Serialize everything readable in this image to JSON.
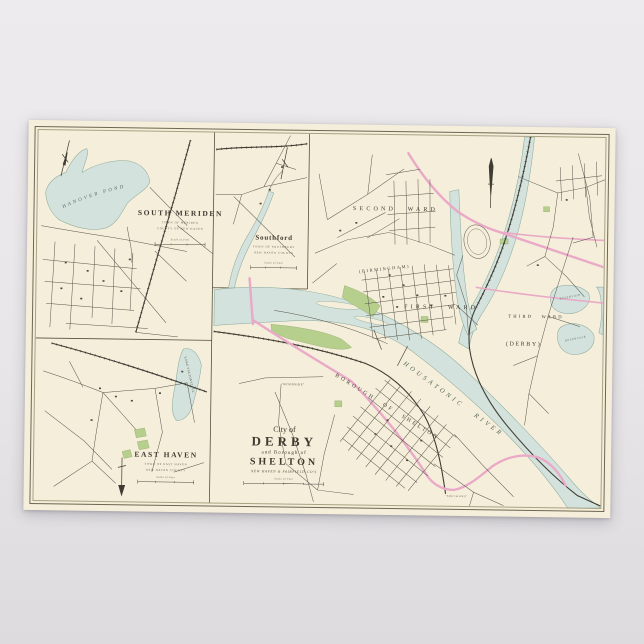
{
  "colors": {
    "background": "#e8e6e8",
    "paper": "#f5eeda",
    "water": "#d3e2dc",
    "road_pink": "#e9a9c7",
    "park_green": "#b7cf8d",
    "ink": "#3e3a31"
  },
  "insets": {
    "south_meriden": {
      "title": "SOUTH MERIDEN",
      "sub1": "TOWN OF MERIDEN",
      "sub2": "COUNTY OF NEW HAVEN",
      "scale_label": "Scale of Feet",
      "pond_label": "HANOVER POND"
    },
    "southford": {
      "title": "Southford",
      "sub1": "TOWN OF SOUTHBURY",
      "sub2": "NEW HAVEN COUNTY",
      "scale_label": "Scale of Feet"
    },
    "east_haven": {
      "title": "EAST HAVEN",
      "sub1": "TOWN OF EAST HAVEN",
      "sub2": "NEW HAVEN COUNTY",
      "scale_label": "Scale of Feet",
      "lake_label": "LAKE SALTONSTALL"
    }
  },
  "main": {
    "labels": {
      "second_ward": "SECOND WARD",
      "first_ward": "FIRST WARD",
      "third_ward": "THIRD WARD",
      "birmingham": "(BIRMINGHAM)",
      "derby": "(DERBY)",
      "river": "HOUSATONIC RIVER",
      "borough": "BOROUGH OF SHELTON",
      "woodside": "\"WOODSIDE\"",
      "south_end": "\"SOUTH END\"",
      "reservoir_a": "RESERVOIR",
      "reservoir_b": "RESERVOIR"
    },
    "title": {
      "line1": "City of",
      "line2": "DERBY",
      "line3": "and Borough of",
      "line4": "SHELTON",
      "line5": "NEW HAVEN & FAIRFIELD CO'S",
      "scale_label": "Scale of Feet"
    }
  }
}
